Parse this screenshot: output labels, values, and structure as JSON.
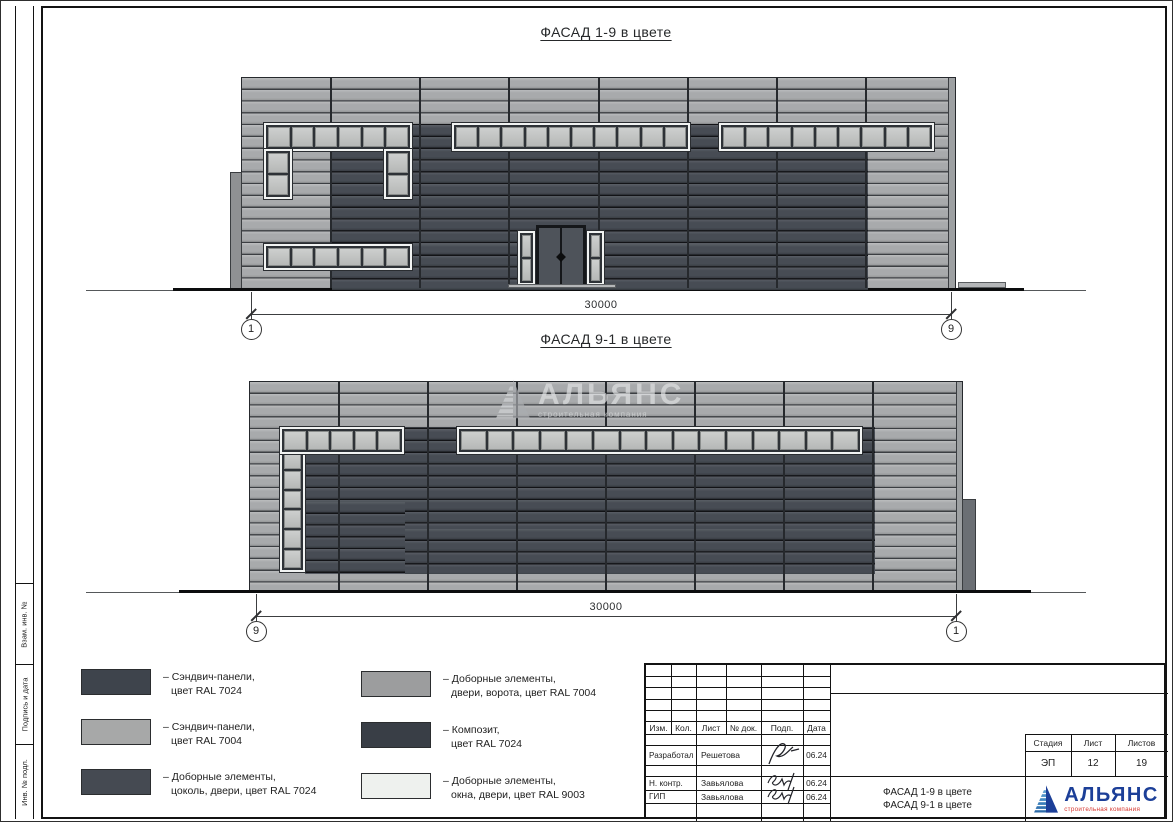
{
  "facades": [
    {
      "title": "ФАСАД 1-9 в цвете",
      "dimension": "30000",
      "axis_left": "1",
      "axis_right": "9"
    },
    {
      "title": "ФАСАД 9-1 в цвете",
      "dimension": "30000",
      "axis_left": "9",
      "axis_right": "1"
    }
  ],
  "legend": {
    "items": [
      {
        "line1": "– Сэндвич-панели,",
        "line2": "цвет RAL 7024",
        "color": "#3e444c"
      },
      {
        "line1": "– Сэндвич-панели,",
        "line2": "цвет RAL 7004",
        "color": "#a7a8a8"
      },
      {
        "line1": "– Доборные элементы,",
        "line2": "цоколь, двери, цвет RAL 7024",
        "color": "#454a52"
      },
      {
        "line1": "– Доборные элементы,",
        "line2": "двери, ворота, цвет RAL 7004",
        "color": "#9c9d9e"
      },
      {
        "line1": "– Композит,",
        "line2": "цвет RAL 7024",
        "color": "#393e46"
      },
      {
        "line1": "– Доборные элементы,",
        "line2": "окна, двери, цвет RAL 9003",
        "color": "#eef1ee"
      }
    ]
  },
  "stamp": {
    "header": [
      "Изм.",
      "Кол.",
      "Лист",
      "№ док.",
      "Подп.",
      "Дата"
    ],
    "sign_rows": [
      {
        "role": "Разработал",
        "name": "Решетова",
        "date": "06.24"
      },
      {
        "role": "Н. контр.",
        "name": "Завьялова",
        "date": "06.24"
      },
      {
        "role": "ГИП",
        "name": "Завьялова",
        "date": "06.24"
      }
    ],
    "doc_title": [
      "ФАСАД 1-9 в цвете",
      "ФАСАД 9-1 в цвете"
    ],
    "stage_header": [
      "Стадия",
      "Лист",
      "Листов"
    ],
    "stage_values": [
      "ЭП",
      "12",
      "19"
    ]
  },
  "logo": {
    "name": "АЛЬЯНС",
    "subtitle": "строительная компания",
    "blue": "#1c3f98",
    "red": "#d6372f"
  },
  "watermark": {
    "name": "АЛЬЯНС",
    "subtitle": "строительная компания"
  },
  "margin_labels": [
    "Взам. инв. №",
    "Подпись и дата",
    "Инв. № подл."
  ],
  "colors": {
    "panel_light": "#a8aaac",
    "panel_dark": "#474c54",
    "window_ral9003": "#eef1ee",
    "ground": "#0c0d0e"
  }
}
